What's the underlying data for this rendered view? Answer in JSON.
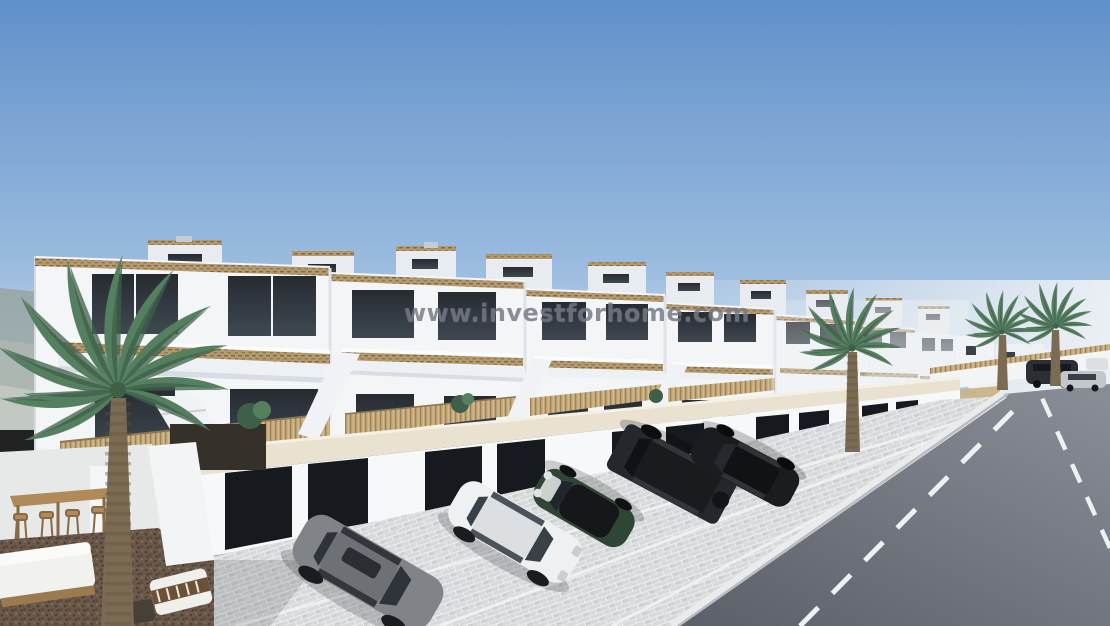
{
  "watermark": {
    "text": "www.investforhome.com"
  },
  "scene": {
    "description": "3D architectural render: row of modern white townhouses with roof terraces, wicker balcony railings, exterior stairs, garage band with parked cars, palm trees, outdoor lounge terrace, small pool and a street receding to the right",
    "vehicles": [
      {
        "name": "grey-sedan",
        "color": "#808387"
      },
      {
        "name": "white-sedan",
        "color": "#eef0f1"
      },
      {
        "name": "green-mini-convertible",
        "color": "#2f4634"
      },
      {
        "name": "black-suv",
        "color": "#24272b"
      },
      {
        "name": "black-sedan",
        "color": "#1a1d20"
      },
      {
        "name": "distant-parked-cars",
        "color": "#2b2f34"
      }
    ]
  },
  "colors": {
    "sky-top": "#6090ca",
    "sky-mid": "#9bbcdf",
    "sky-horizon": "#d9e5f1",
    "haze": "#edf1f4",
    "hill": "#95a09a",
    "wall-bright": "#f3f5f7",
    "wall-soft": "#e8ecf0",
    "wall-shade": "#d6dce2",
    "window": "#262b31",
    "window-lite": "#3f4850",
    "wicker": "#b59a6e",
    "wicker-dark": "#7d6a4a",
    "cane": "#c2a878",
    "coping": "#e9e2d1",
    "garage-door": "#16191d",
    "pavement": "#d7d9db",
    "pave-line": "#f0f2f3",
    "road": "#5b5f68",
    "road-far": "#878c95",
    "curb": "#e9ebed",
    "gravel": "#6a594a",
    "gravel-dark": "#4e4032",
    "palm": "#55805f",
    "palm-dark": "#3e6049",
    "trunk": "#7a6b52",
    "wood": "#b08a58",
    "pool": "#a6cfdf",
    "watermark": "rgba(106,111,126,0.78)"
  }
}
